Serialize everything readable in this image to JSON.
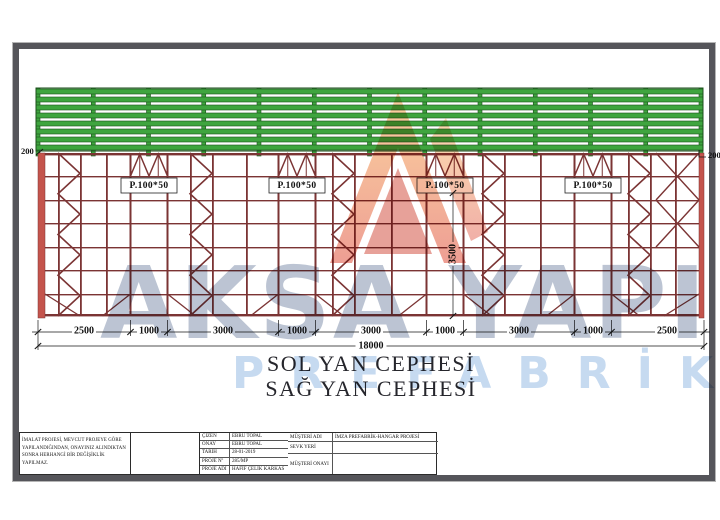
{
  "drawing": {
    "title_line1": "SOL YAN  CEPHESİ",
    "title_line2": "SAĞ YAN  CEPHESİ",
    "purlin_labels": [
      "P.100*50",
      "P.100*50",
      "P.100*50",
      "P.100*50"
    ],
    "dims": [
      "2500",
      "1000",
      "3000",
      "1000",
      "3000",
      "1000",
      "3000",
      "1000",
      "2500"
    ],
    "total_dim": "18000",
    "height_dim": "3500",
    "left_offset": "200",
    "right_offset": "200",
    "colors": {
      "steel_frame": "#7b3434",
      "steel_accent": "#c4544c",
      "purlin_green": "#3fa53f",
      "dimension": "#161616"
    }
  },
  "watermark": {
    "line1": "AKSA YAPI",
    "line2": "PREFABRİK",
    "color1": "#8494ae",
    "color2": "#a8c6e8",
    "logo_icon": "flame-logo"
  },
  "title_block": {
    "note_lines": [
      "İMALAT PROJESİ, MEVCUT PROJEYE GÖRE",
      "YAPILANDIĞINDAN, ONAYINIZ ALINDIKTAN",
      "SONRA HERHANGİ BİR DEĞİŞİKLİK YAPILMAZ."
    ],
    "left_rows": [
      {
        "label": "ÇİZEN",
        "value": "EBRU TOPAL"
      },
      {
        "label": "ONAY",
        "value": "EBRU TOPAL"
      },
      {
        "label": "TARİH",
        "value": "28-01-2019"
      },
      {
        "label": "PROJE Nº",
        "value": "285/MP"
      },
      {
        "label": "PROJE ADI",
        "value": "HAFİF ÇELİK KARKAS"
      }
    ],
    "right_rows": [
      {
        "label": "MÜŞTERİ ADI",
        "value": "İMZA PREFABRİK-HANGAR PROJESİ"
      },
      {
        "label": "SEVK YERİ",
        "value": ""
      },
      {
        "label": "MÜŞTERİ ONAYI",
        "value": ""
      }
    ]
  }
}
